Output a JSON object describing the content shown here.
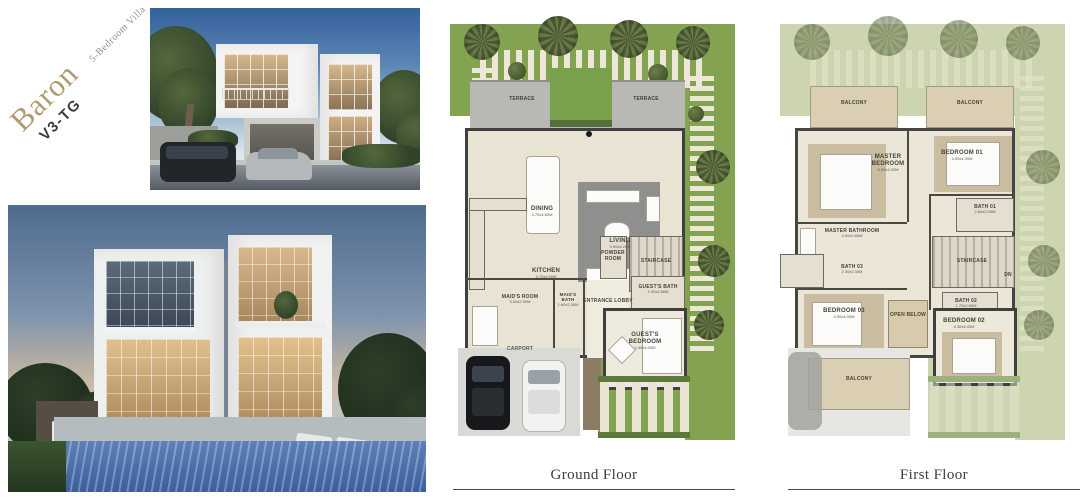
{
  "brand": {
    "name": "Baron",
    "code": "V3-TG",
    "subtitle": "5-Bedroom Villa"
  },
  "ground_floor": {
    "title": "Ground Floor",
    "labels": {
      "terrace_left": "TERRACE",
      "terrace_right": "TERRACE",
      "dining": "DINING",
      "dining_dim": "3.70x4.60M",
      "living": "LIVING",
      "living_dim": "4.90x4.20M",
      "kitchen": "KITCHEN",
      "kitchen_dim": "3.70x4.00M",
      "powder_room": "POWDER ROOM",
      "staircase": "STAIRCASE",
      "maids_room": "MAID'S ROOM",
      "maids_room_dim": "3.00x2.30M",
      "maids_bath": "MAID'S BATH",
      "maids_bath_dim": "1.60x2.30M",
      "entrance_lobby": "ENTRANCE LOBBY",
      "guests_bath": "GUEST'S BATH",
      "guests_bath_dim": "1.90x2.60M",
      "guests_bedroom": "GUEST'S BEDROOM",
      "guests_bedroom_dim": "4.30x4.00M",
      "carport": "CARPORT"
    }
  },
  "first_floor": {
    "title": "First Floor",
    "labels": {
      "balcony_left": "BALCONY",
      "balcony_right": "BALCONY",
      "master_bedroom": "MASTER BEDROOM",
      "master_bedroom_dim": "5.00x4.20M",
      "bedroom_01": "BEDROOM 01",
      "bedroom_01_dim": "4.00x4.00M",
      "master_bathroom": "MASTER BATHROOM",
      "master_bathroom_dim": "3.00x2.60M",
      "bath_01": "BATH 01",
      "bath_01_dim": "2.60x2.00M",
      "bath_03": "BATH 03",
      "bath_03_dim": "2.30x2.30M",
      "staircase": "STAIRCASE",
      "dn": "DN",
      "bath_02": "BATH 02",
      "bath_02_dim": "1.70x2.60M",
      "bedroom_03": "BEDROOM 03",
      "bedroom_03_dim": "4.00x4.00M",
      "open_below": "OPEN BELOW",
      "bedroom_02": "BEDROOM 02",
      "bedroom_02_dim": "4.30x4.00M",
      "balcony_bottom": "BALCONY"
    }
  },
  "palette": {
    "brand_gold": "#b29a70",
    "grass_green": "#84a351",
    "grass_faded": "#ccd5af",
    "wall_dark": "#3f3f3f",
    "terrace_gray": "#b8b8b5",
    "floor_beige": "#e9e3d4",
    "balcony_tan": "#dacfb3",
    "pool_blue": "#3c5e9d",
    "sky_day_blue": "#33619b",
    "sky_dusk": "#4e6b8d"
  }
}
